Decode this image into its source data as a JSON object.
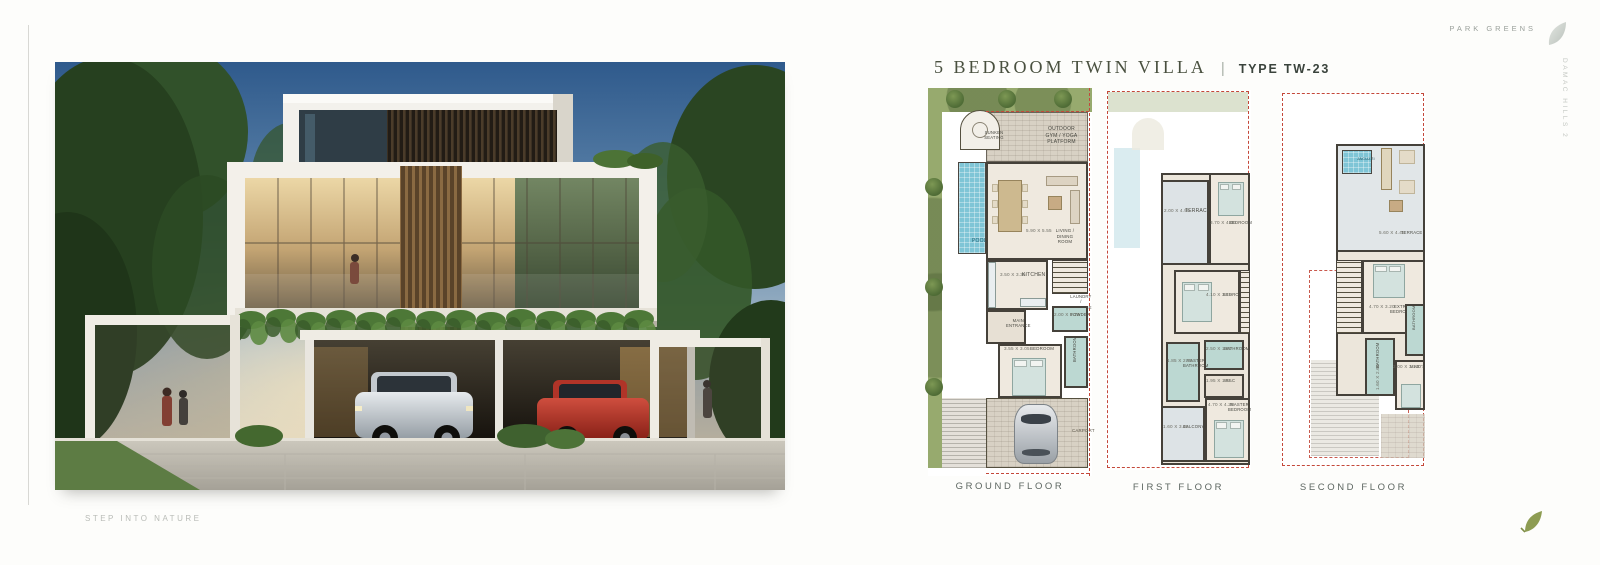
{
  "brand": {
    "name": "PARK GREENS",
    "side_text": "DAMAC HILLS 2",
    "tagline": "STEP INTO NATURE"
  },
  "title": {
    "main": "5 BEDROOM TWIN VILLA",
    "separator": "|",
    "type_label": "TYPE TW-23"
  },
  "colors": {
    "accent_red_dash": "#c4483a",
    "plan_wall": "#45413a",
    "plan_floor": "#efe9df",
    "bathroom_teal": "#bcd8d2",
    "pool_blue": "#7fc5d6",
    "garden_green": "#97aa6e",
    "leaf_green": "#8d9c52",
    "leaf_silver": "#c9cec9"
  },
  "floors": [
    {
      "label": "GROUND FLOOR",
      "rooms": [
        {
          "label": "SUNKEN SEATING",
          "dims": ""
        },
        {
          "label": "OUTDOOR GYM / YOGA PLATFORM",
          "dims": ""
        },
        {
          "label": "POOL",
          "dims": ""
        },
        {
          "label": "LIVING / DINING ROOM",
          "dims": "5.90 X 5.55"
        },
        {
          "label": "KITCHEN",
          "dims": "3.50 X 3.35"
        },
        {
          "label": "LAUNDRY / STORAGE",
          "dims": ""
        },
        {
          "label": "MAIN ENTRANCE",
          "dims": ""
        },
        {
          "label": "POWDER",
          "dims": "2.00 X 1.20"
        },
        {
          "label": "BEDROOM",
          "dims": "3.55 X 3.05"
        },
        {
          "label": "BATHROOM",
          "dims": ""
        },
        {
          "label": "CARPORT",
          "dims": ""
        }
      ]
    },
    {
      "label": "FIRST FLOOR",
      "rooms": [
        {
          "label": "TERRACE",
          "dims": "2.00 X 4.90"
        },
        {
          "label": "BEDROOM",
          "dims": "3.70 X 4.00"
        },
        {
          "label": "BEDROOM",
          "dims": "4.10 X 3.15"
        },
        {
          "label": "BATHROOM",
          "dims": "2.50 X 1.60"
        },
        {
          "label": "MASTER BATHROOM",
          "dims": "1.85 X 2.75"
        },
        {
          "label": "W.I.C",
          "dims": "1.95 X 1.85"
        },
        {
          "label": "BALCONY",
          "dims": "1.60 X 3.45"
        },
        {
          "label": "MASTER BEDROOM",
          "dims": "4.70 X 4.25"
        }
      ]
    },
    {
      "label": "SECOND FLOOR",
      "rooms": [
        {
          "label": "JACUZZI",
          "dims": ""
        },
        {
          "label": "TERRACE",
          "dims": "5.60 X 4.45"
        },
        {
          "label": "EXTRA BEDROOM",
          "dims": "4.70 X 3.20"
        },
        {
          "label": "BATHROOM",
          "dims": "1.60 X 2.60"
        },
        {
          "label": "BATHROOM",
          "dims": ""
        },
        {
          "label": "MAID'S",
          "dims": "2.00 X 3.10"
        }
      ]
    }
  ]
}
